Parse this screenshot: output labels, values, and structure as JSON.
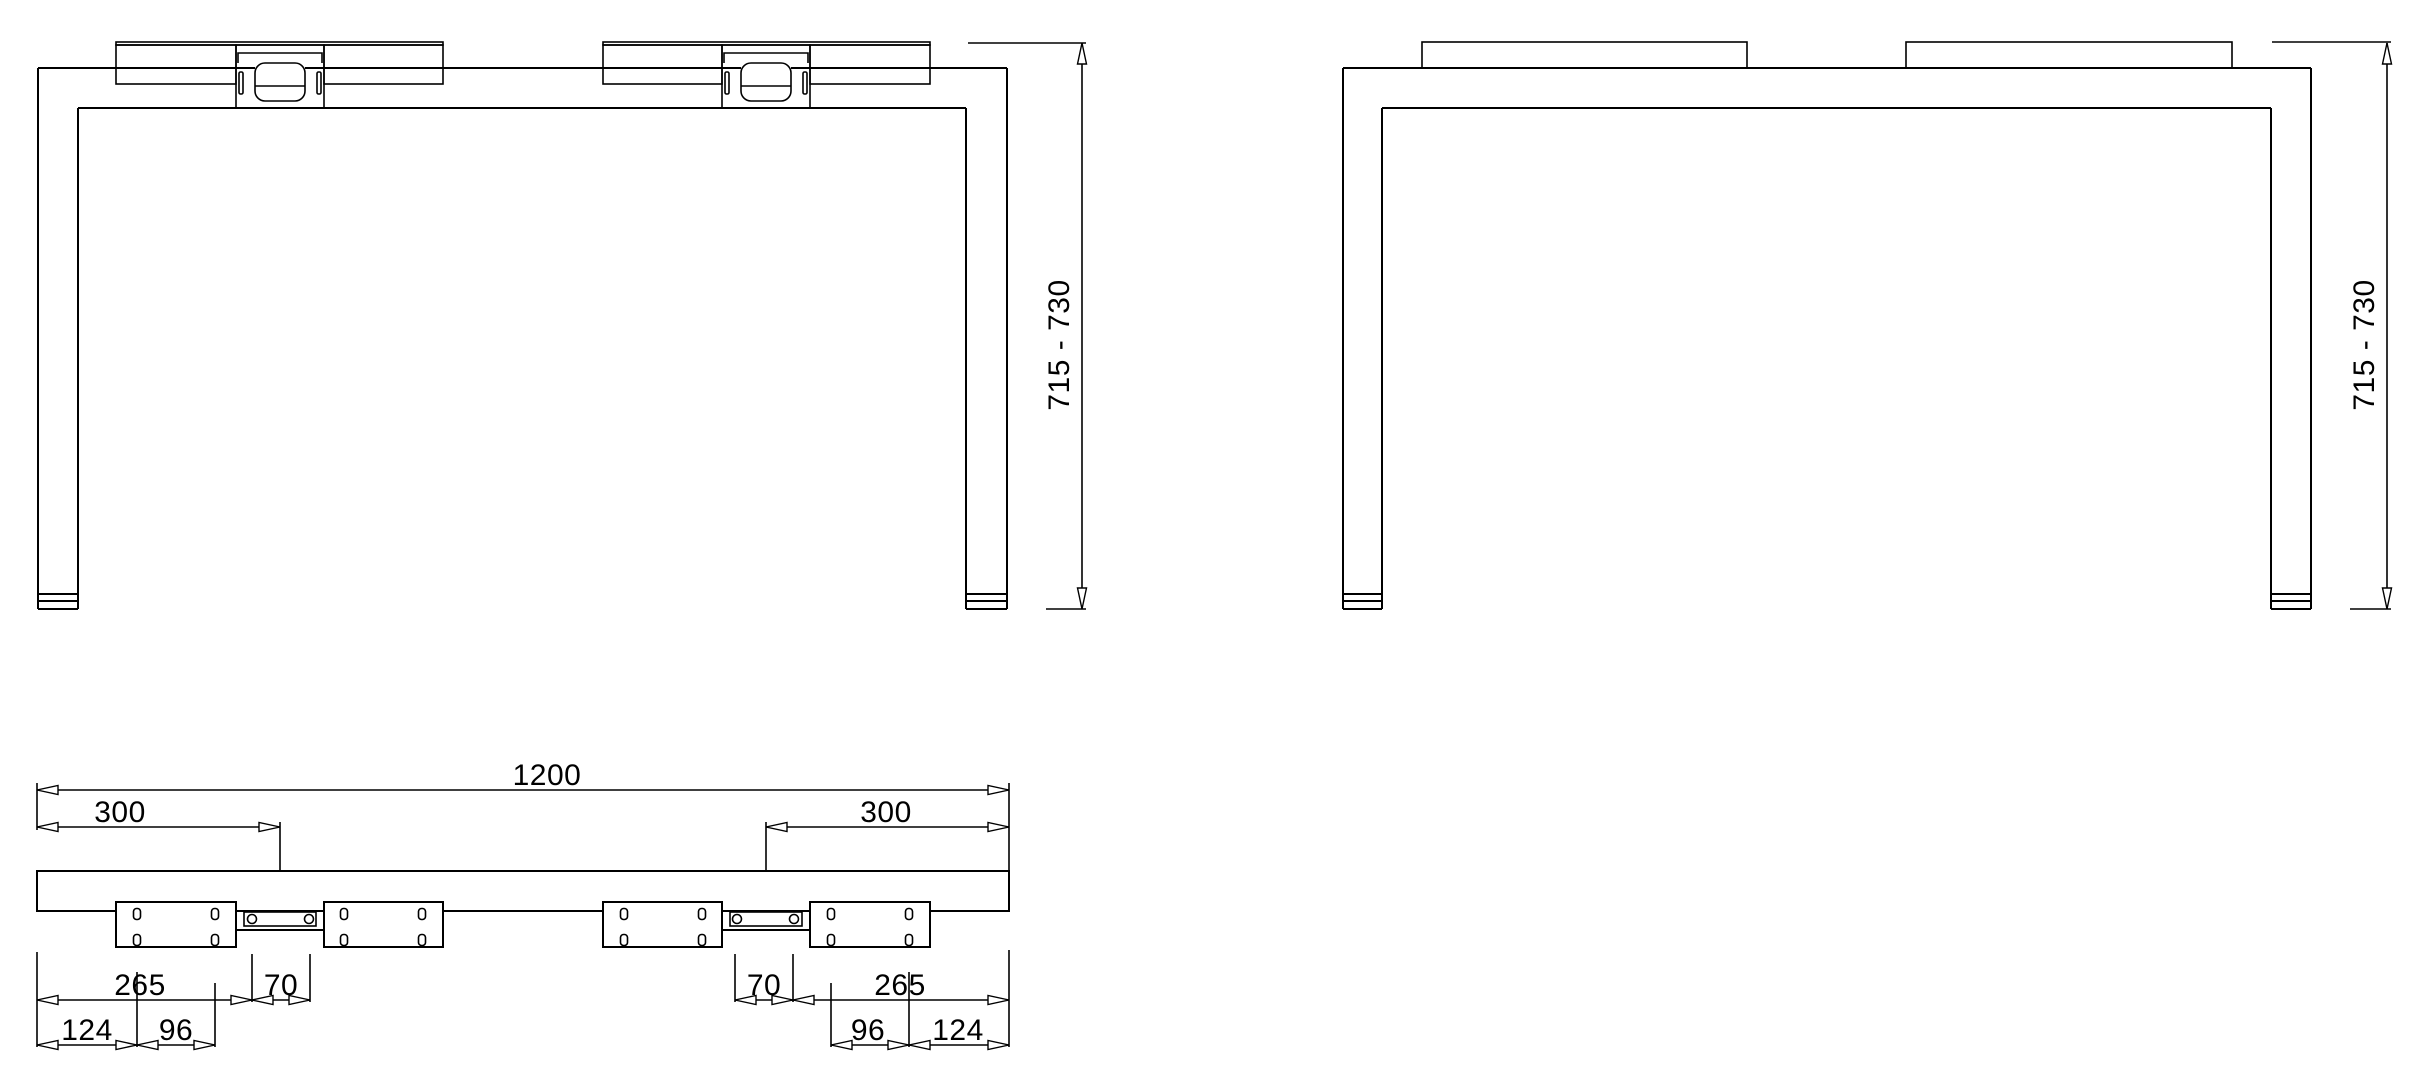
{
  "drawing": {
    "background": "#ffffff",
    "line_color": "#000000",
    "views": {
      "front": {
        "height_range": "715 - 730"
      },
      "back": {
        "height_range": "715 - 730"
      },
      "top": {
        "beam_length": "1200",
        "left_bracket_offset": "300",
        "right_bracket_offset": "300",
        "left_chain": {
          "d265": "265",
          "d70": "70",
          "d124": "124",
          "d96": "96"
        },
        "right_chain": {
          "d70": "70",
          "d265": "265",
          "d96": "96",
          "d124": "124"
        }
      }
    }
  }
}
